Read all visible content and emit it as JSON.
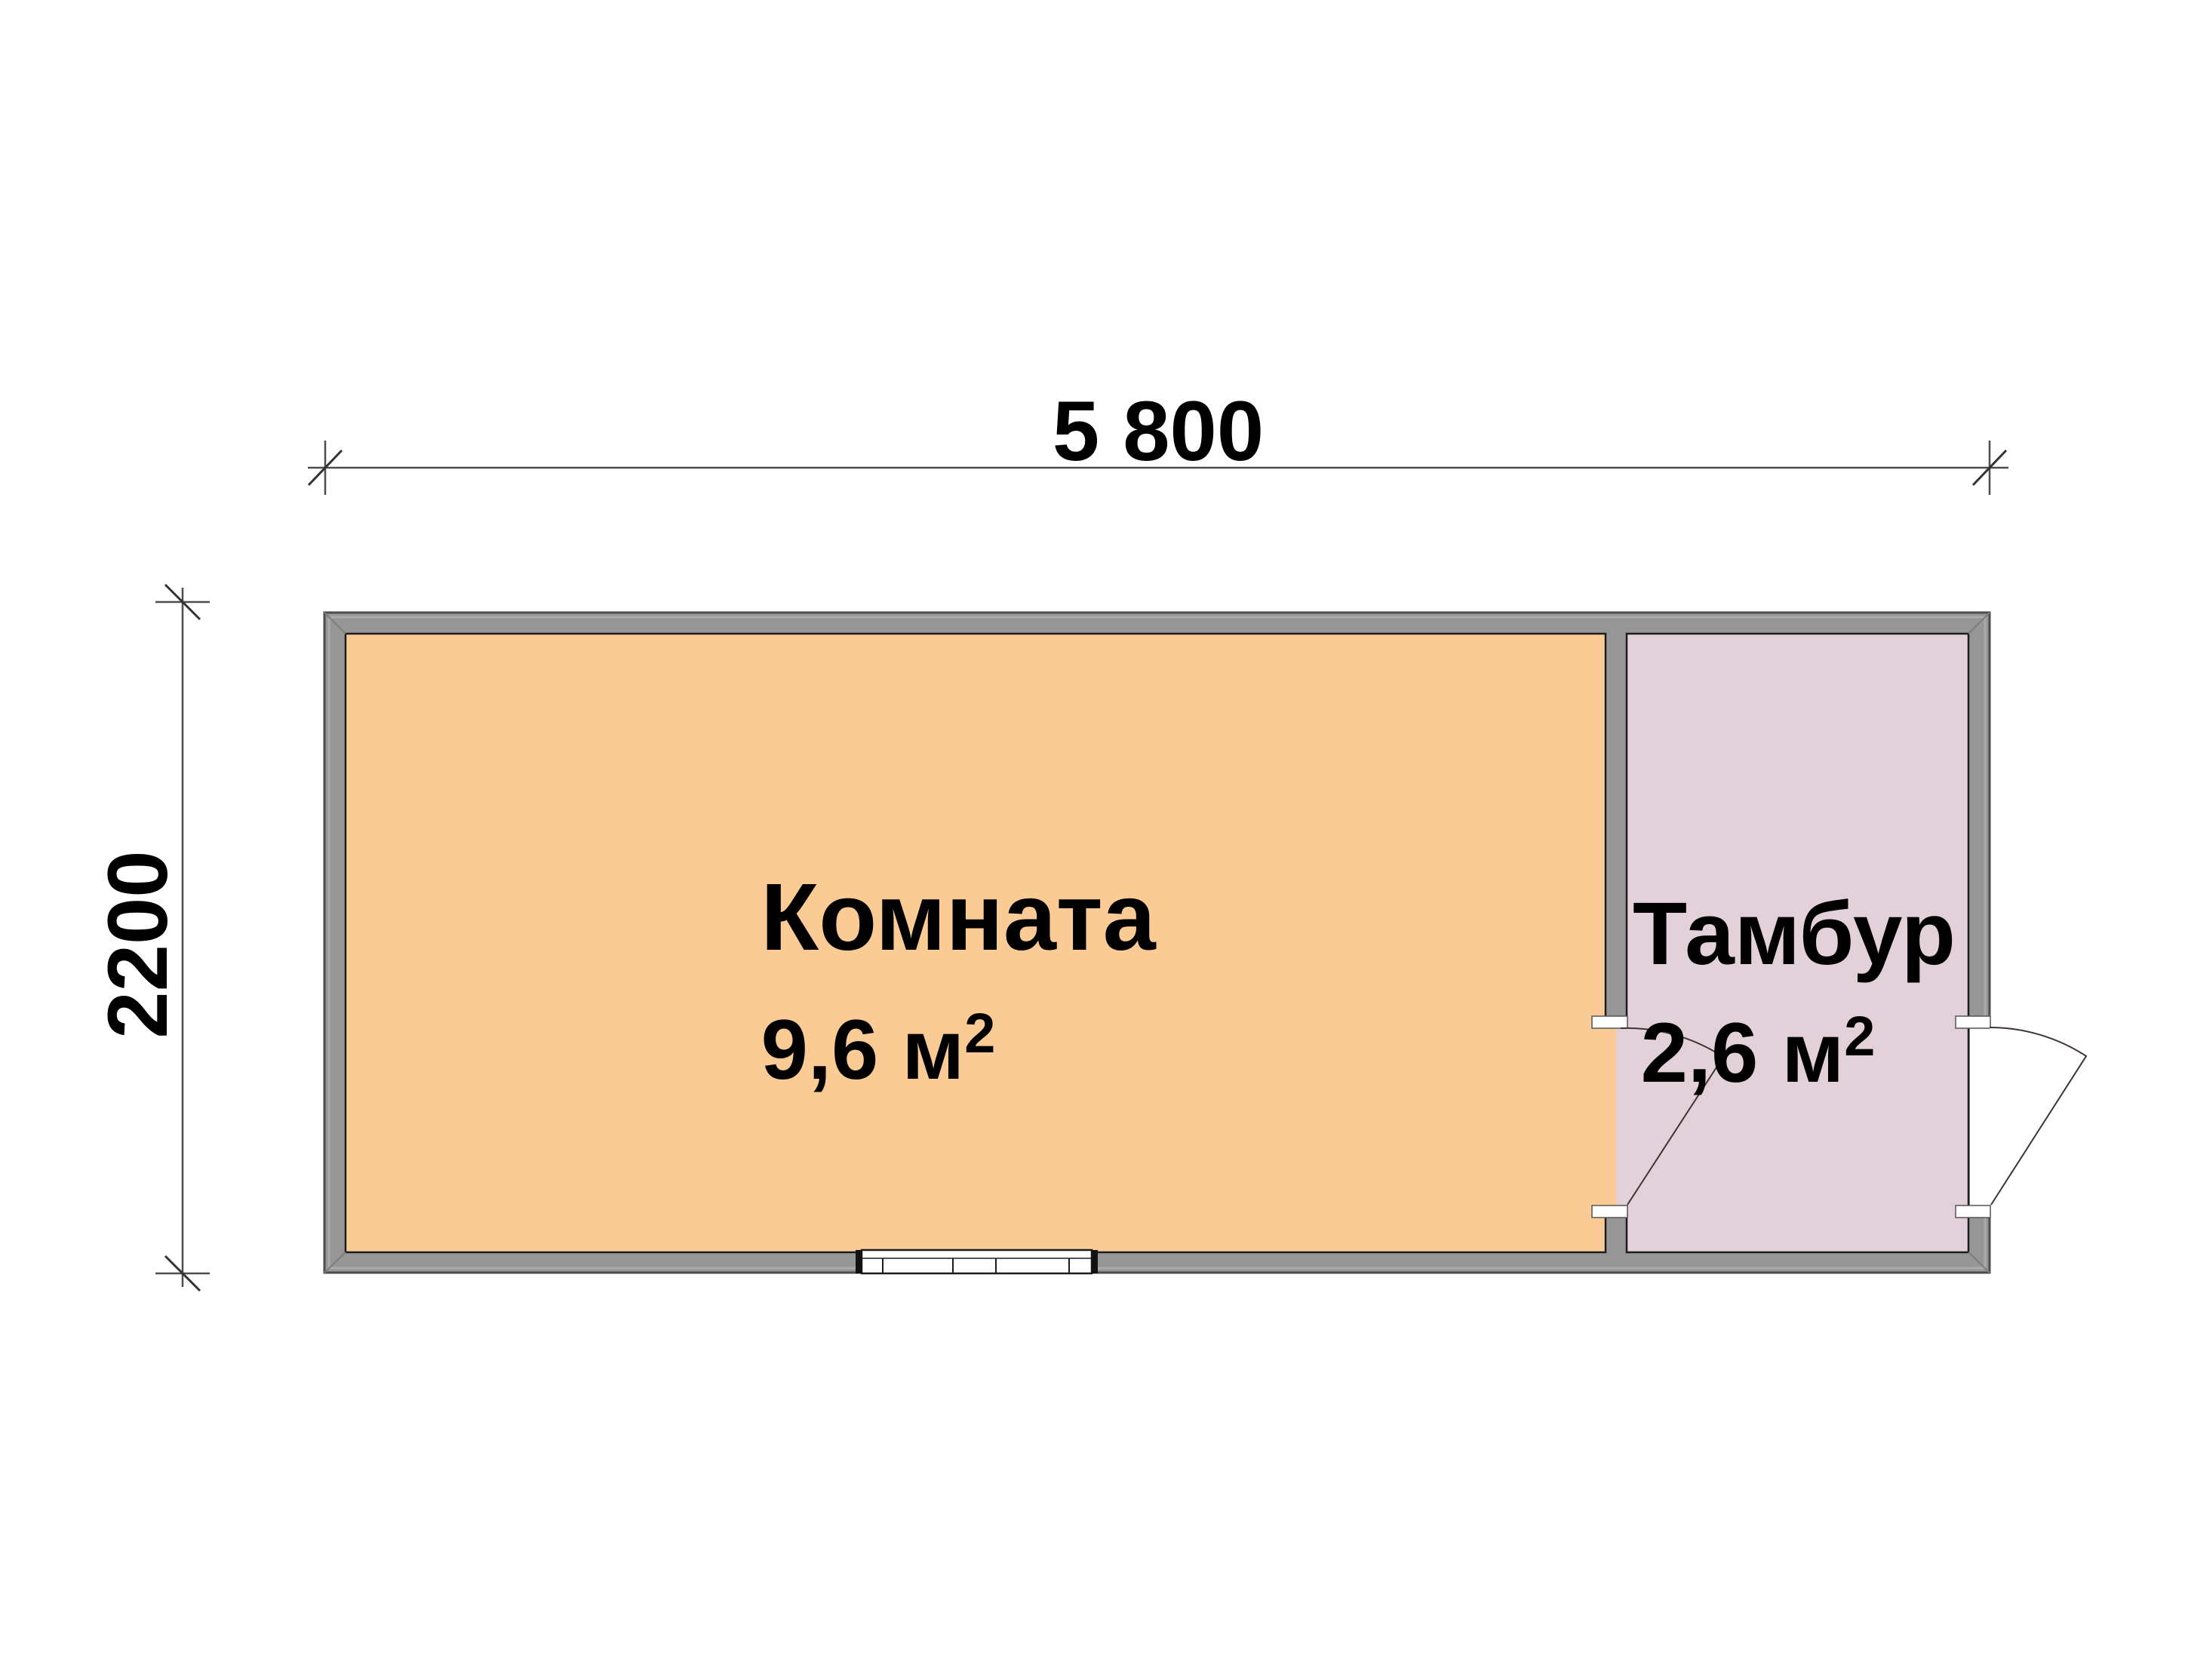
{
  "plan": {
    "title": "floor-plan-cabin",
    "dim_width": "5 800",
    "dim_height": "2200",
    "rooms": [
      {
        "name": "Комната",
        "area": "9,6 м",
        "area_exp": "2"
      },
      {
        "name": "Тамбур",
        "area": "2,6 м",
        "area_exp": "2"
      }
    ]
  },
  "colors": {
    "background": "#ffffff",
    "wall": "#969696",
    "wall_highlight": "#ababab",
    "wall_outline": "#4c4c4c",
    "room_main": "#fbcb95",
    "room_vestibule": "#e2d1d8",
    "line_dark": "#1c1c1c",
    "dim_line": "#4d4d4d",
    "door_line": "#3d3535",
    "white": "#ffffff"
  }
}
